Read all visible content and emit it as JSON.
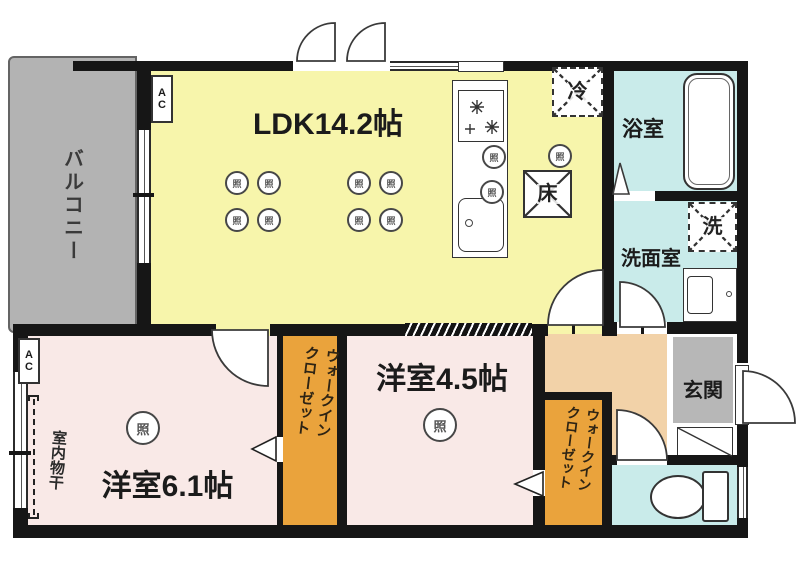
{
  "rooms": {
    "balcony": "バルコニー",
    "ldk": "LDK14.2帖",
    "bath": "浴室",
    "washroom": "洗面室",
    "entrance": "玄関",
    "bedroom1": "洋室6.1帖",
    "bedroom2": "洋室4.5帖",
    "wic_line1": "ウォークイン",
    "wic_line2": "クローゼット",
    "indoor_drying": "室内物干"
  },
  "symbols": {
    "ac": "AC",
    "light": "照",
    "fridge": "冷",
    "floor_storage": "床",
    "washer": "洗"
  },
  "colors": {
    "ldk_floor": "#f7f5ab",
    "bedroom_floor": "#f9e9e7",
    "closet": "#eaa33c",
    "hallway": "#f2d2a8",
    "wet_area": "#c9ebea",
    "balcony_gray": "#b3b3b3",
    "entrance_gray": "#b7b7b7",
    "wall": "#161616"
  }
}
